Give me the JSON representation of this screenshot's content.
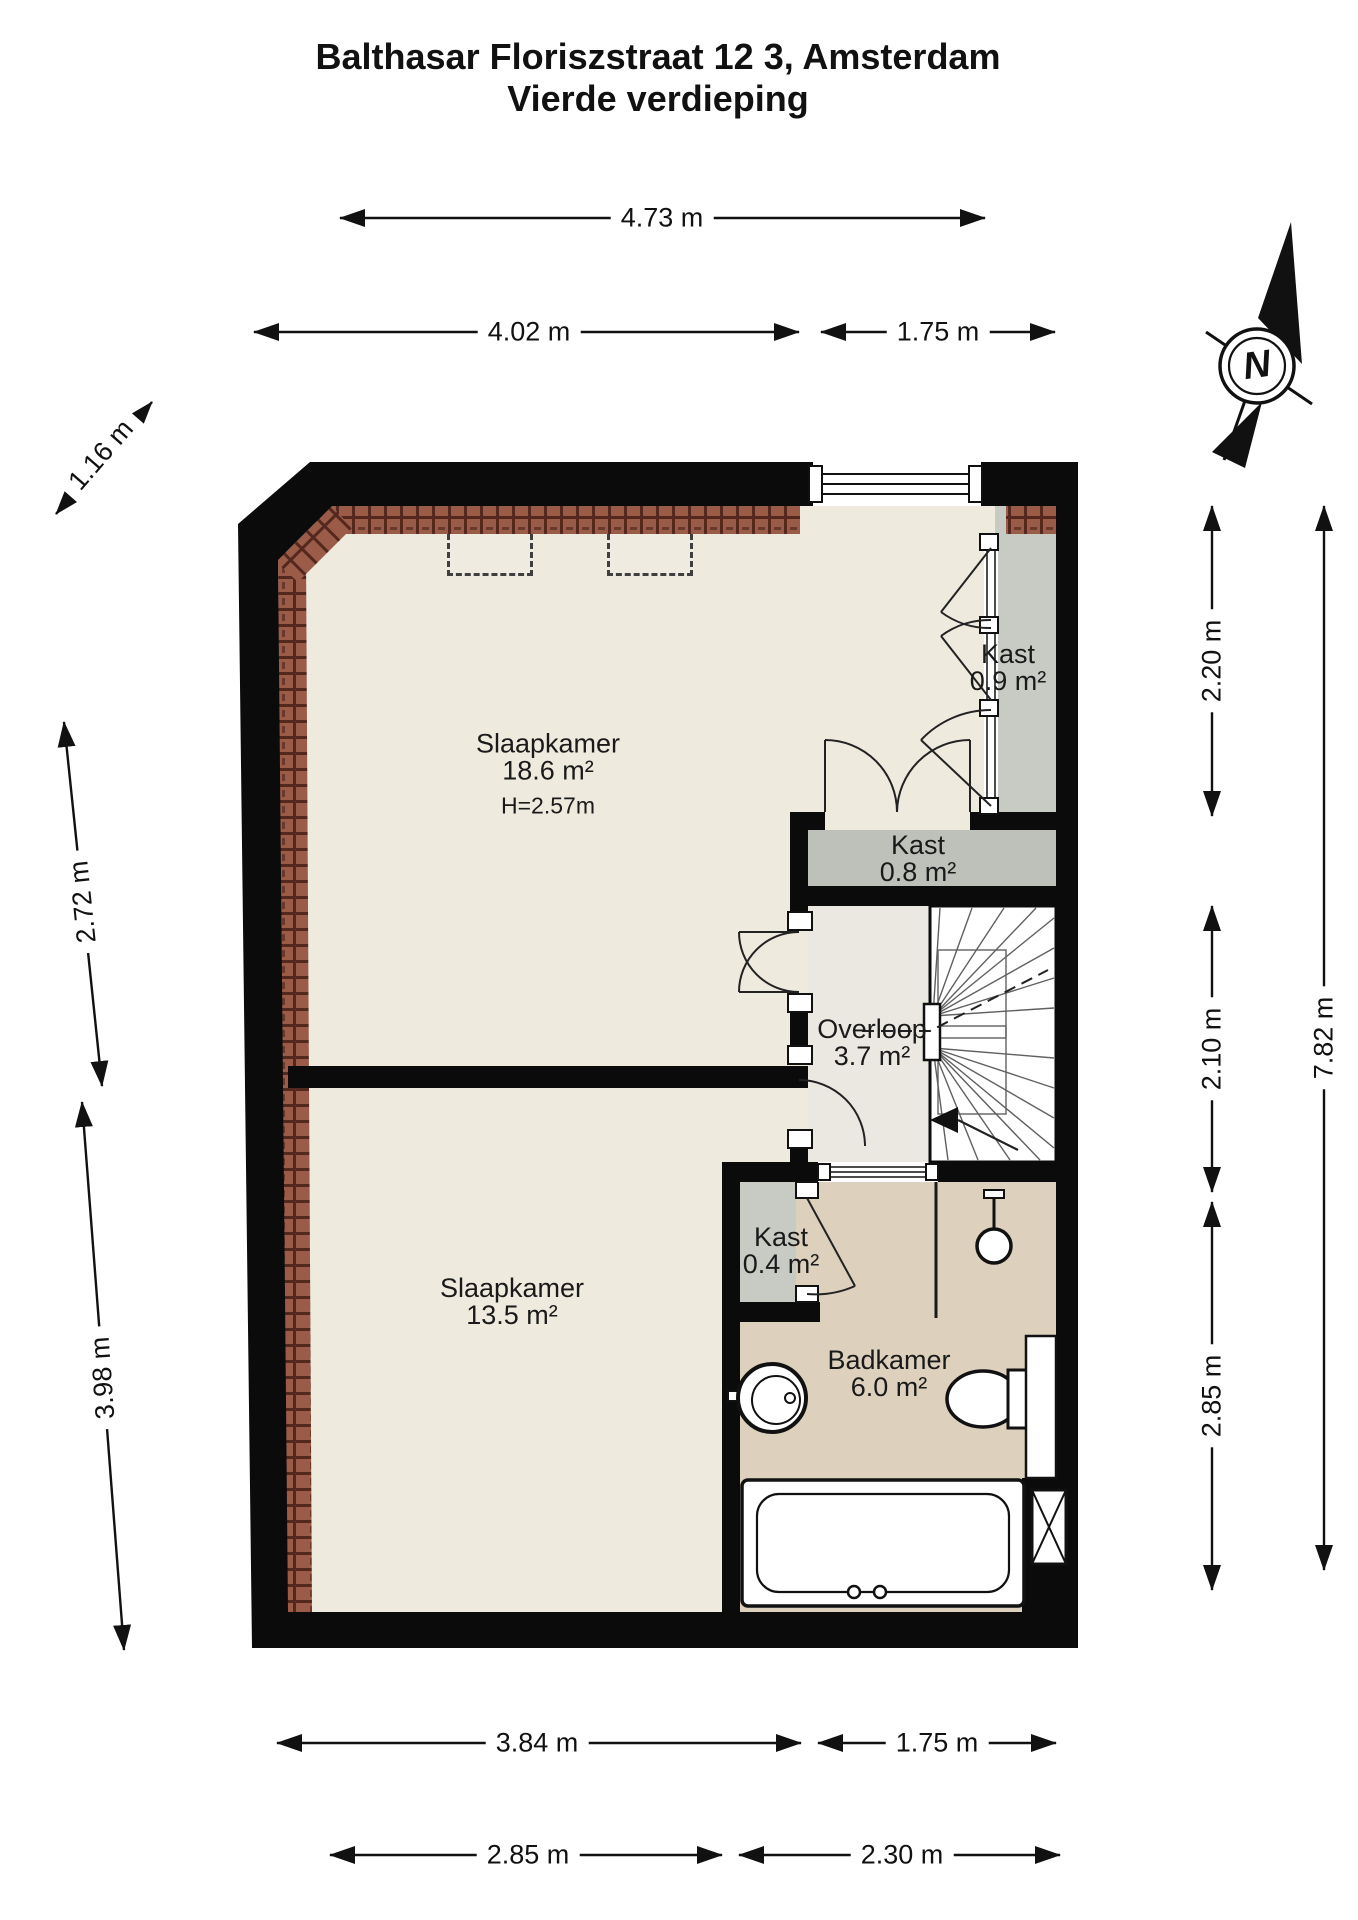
{
  "title": {
    "line1": "Balthasar Floriszstraat 12 3, Amsterdam",
    "line2": "Vierde verdieping"
  },
  "compass": {
    "north_label": "N"
  },
  "rooms": {
    "slaapkamer_1": {
      "name": "Slaapkamer",
      "area": "18.6 m²",
      "ceiling_height": "H=2.57m"
    },
    "kast_1": {
      "name": "Kast",
      "area": "0.9 m²"
    },
    "kast_2": {
      "name": "Kast",
      "area": "0.8 m²"
    },
    "overloop": {
      "name": "Overloop",
      "area": "3.7 m²"
    },
    "kast_3": {
      "name": "Kast",
      "area": "0.4 m²"
    },
    "slaapkamer_2": {
      "name": "Slaapkamer",
      "area": "13.5 m²"
    },
    "badkamer": {
      "name": "Badkamer",
      "area": "6.0 m²"
    }
  },
  "dimensions": {
    "top_total": "4.73 m",
    "top_left": "4.02 m",
    "top_right": "1.75 m",
    "left_diagonal": "1.16 m",
    "left_upper": "2.72 m",
    "left_lower": "3.98 m",
    "right_upper": "2.20 m",
    "right_middle": "2.10 m",
    "right_lower": "2.85 m",
    "right_total": "7.82 m",
    "bottom_left": "3.84 m",
    "bottom_right": "1.75 m",
    "bottom_left_2": "2.85 m",
    "bottom_right_2": "2.30 m"
  },
  "colors": {
    "wall": "#0b0b0b",
    "bedroom_floor": "#efeade",
    "overloop_floor": "#ebe8e1",
    "closet_floor": "#c7cbc4",
    "closet2_floor": "#bdc1ba",
    "bathroom_floor": "#ddd0bd",
    "roof_tiles": "#9a5c49",
    "roof_tile_joint": "#55281e",
    "dimension_text": "#111111"
  }
}
